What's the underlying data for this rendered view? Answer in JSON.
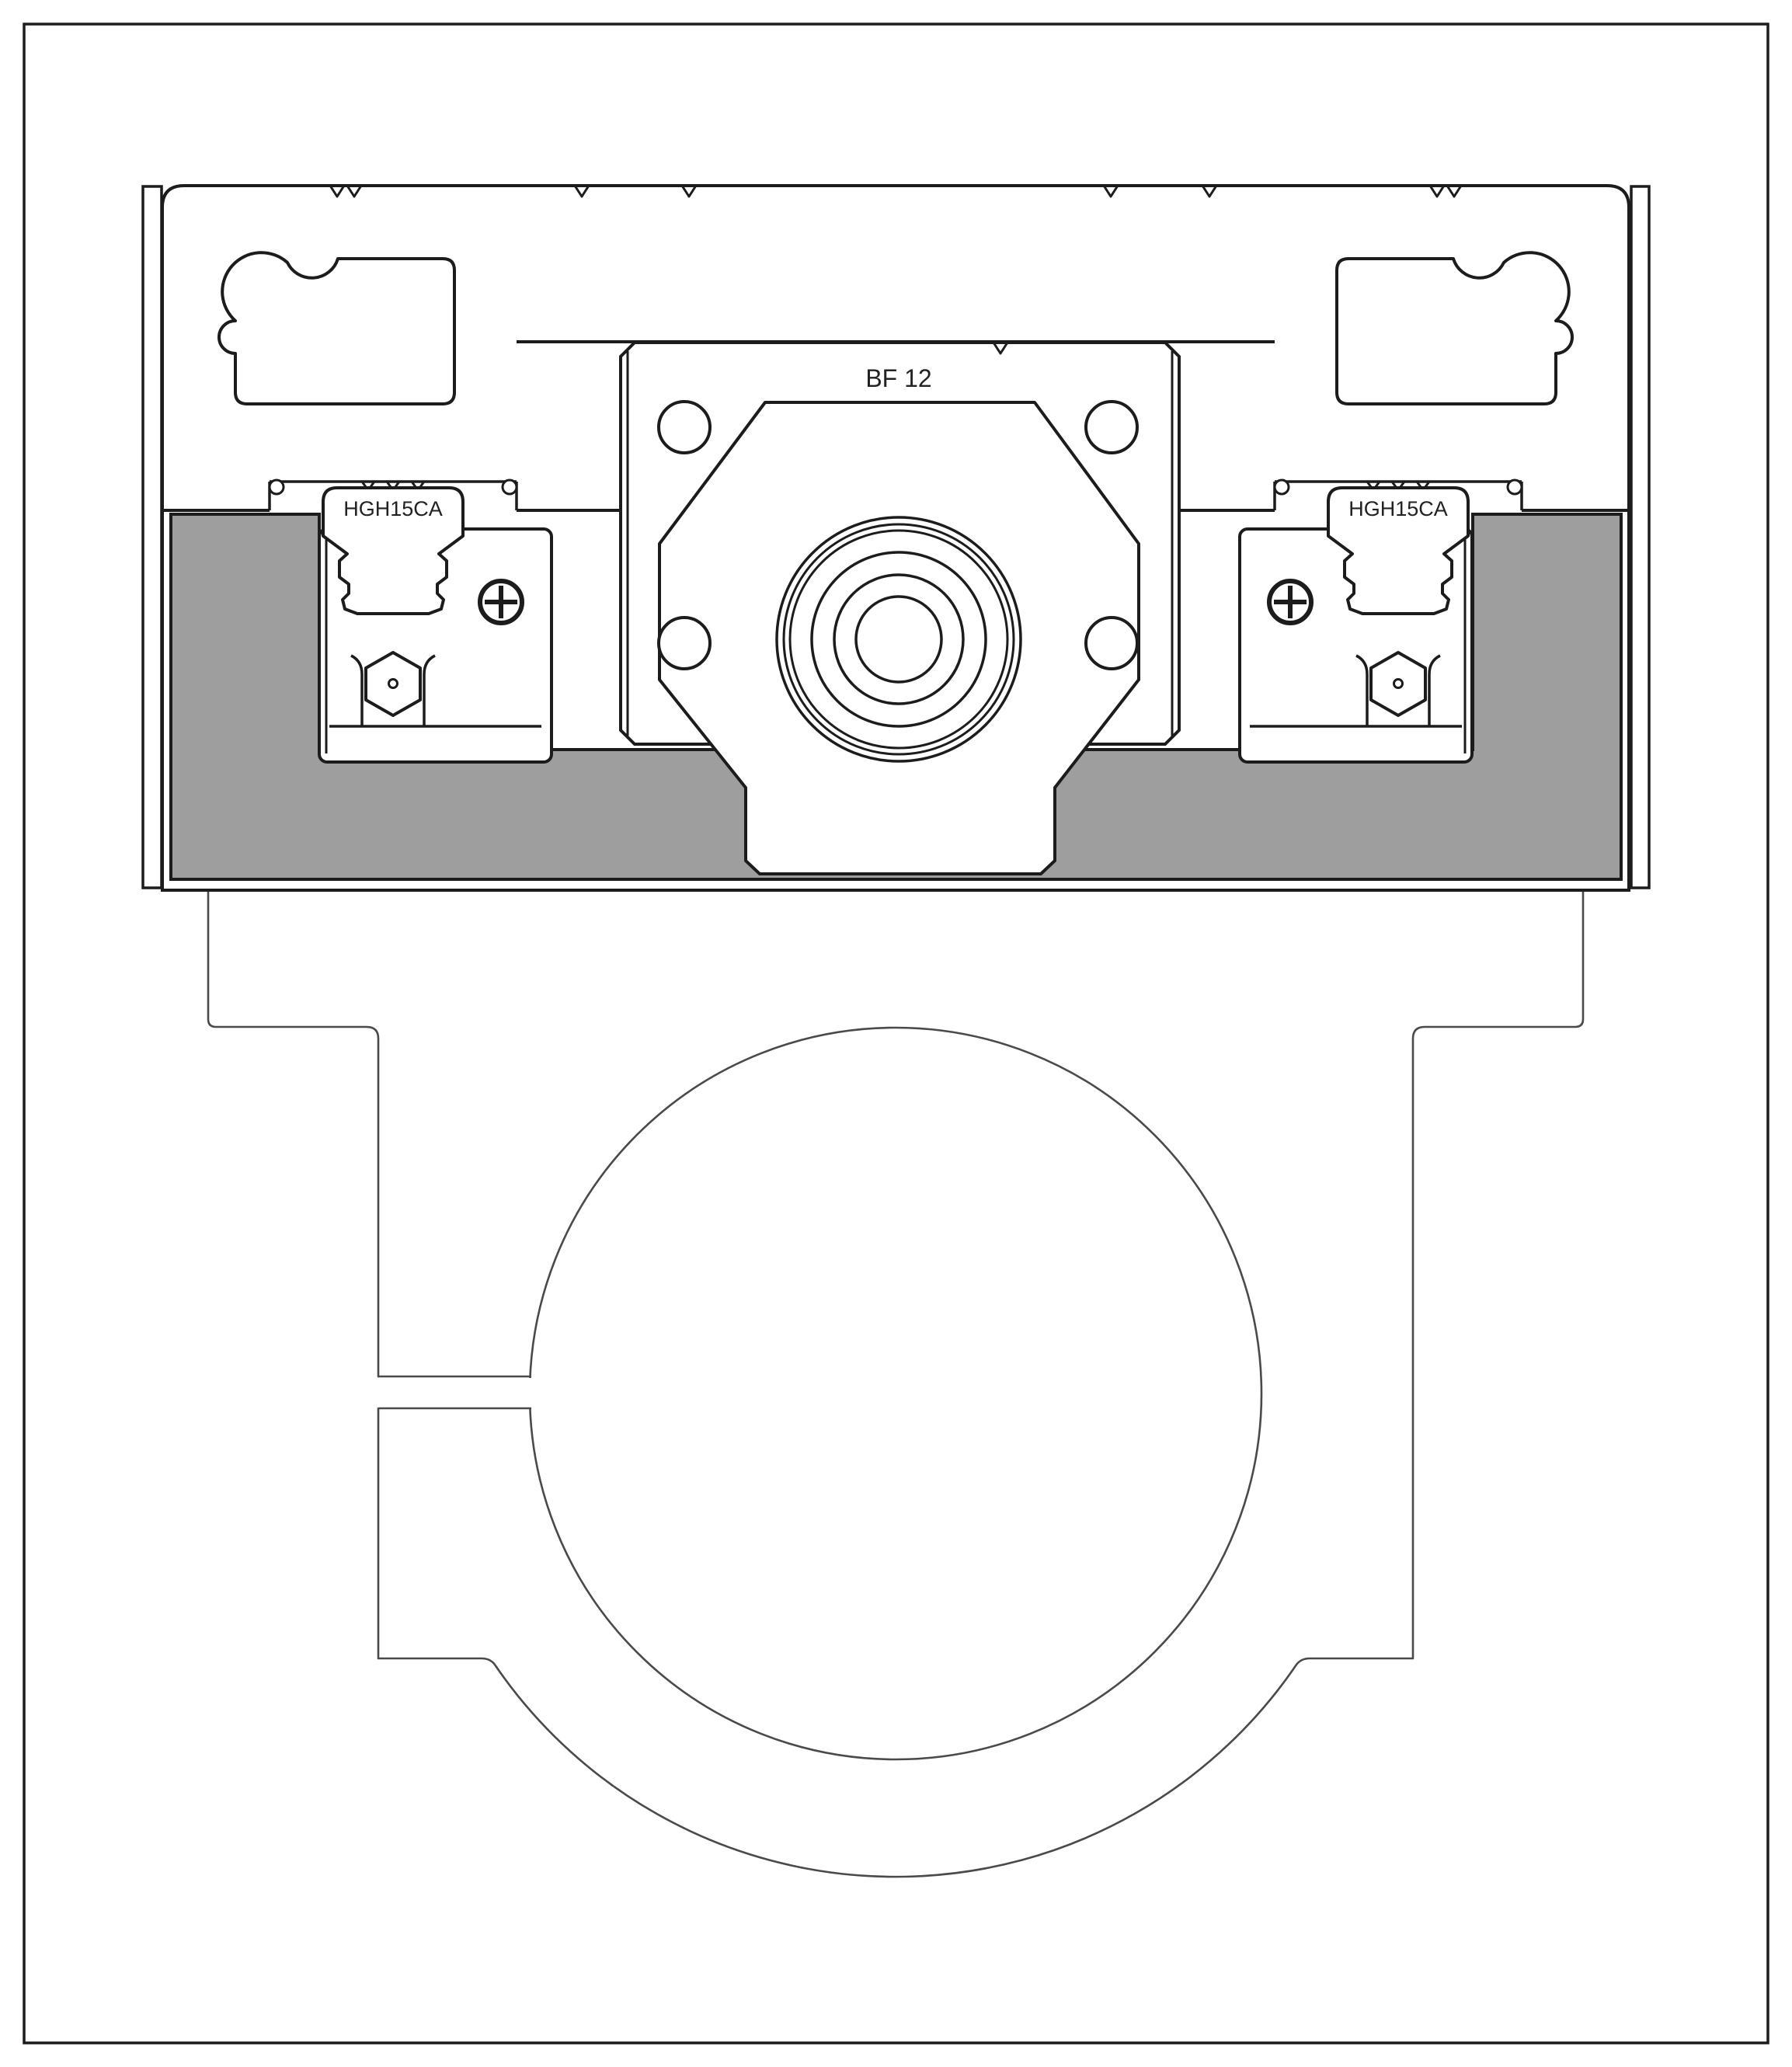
{
  "drawing": {
    "bearing_block_label": "BF 12",
    "left_carriage_label": "HGH15CA",
    "right_carriage_label": "HGH15CA"
  },
  "colors": {
    "line": "#1c1c1c",
    "thin_line": "#4a4a4a",
    "plate_fill": "#9e9e9e",
    "background": "#ffffff"
  }
}
